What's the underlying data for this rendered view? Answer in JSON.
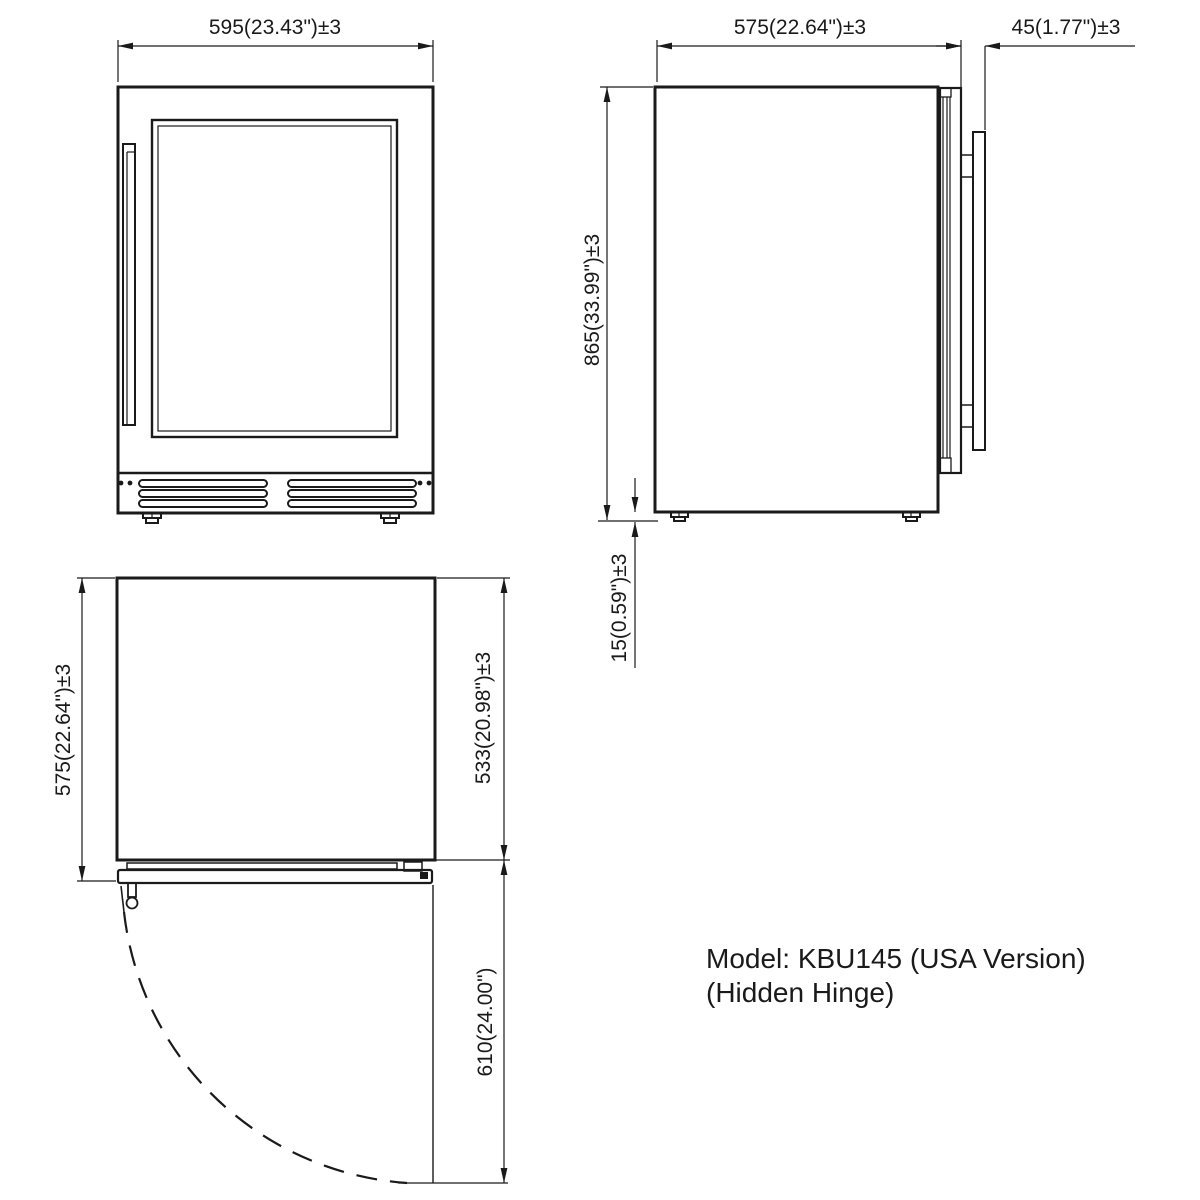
{
  "drawing": {
    "model_line1": "Model: KBU145 (USA Version)",
    "model_line2": "(Hidden Hinge)",
    "dimensions": {
      "front_width": "595(23.43\")±3",
      "side_depth": "575(22.64\")±3",
      "door_thickness": "45(1.77\")±3",
      "total_height": "865(33.99\")±3",
      "leg_height": "15(0.59\")±3",
      "top_depth": "575(22.64\")±3",
      "body_depth": "533(20.98\")±3",
      "door_swing": "610(24.00\")"
    },
    "colors": {
      "line": "#1a1a1a",
      "background": "#ffffff"
    }
  }
}
